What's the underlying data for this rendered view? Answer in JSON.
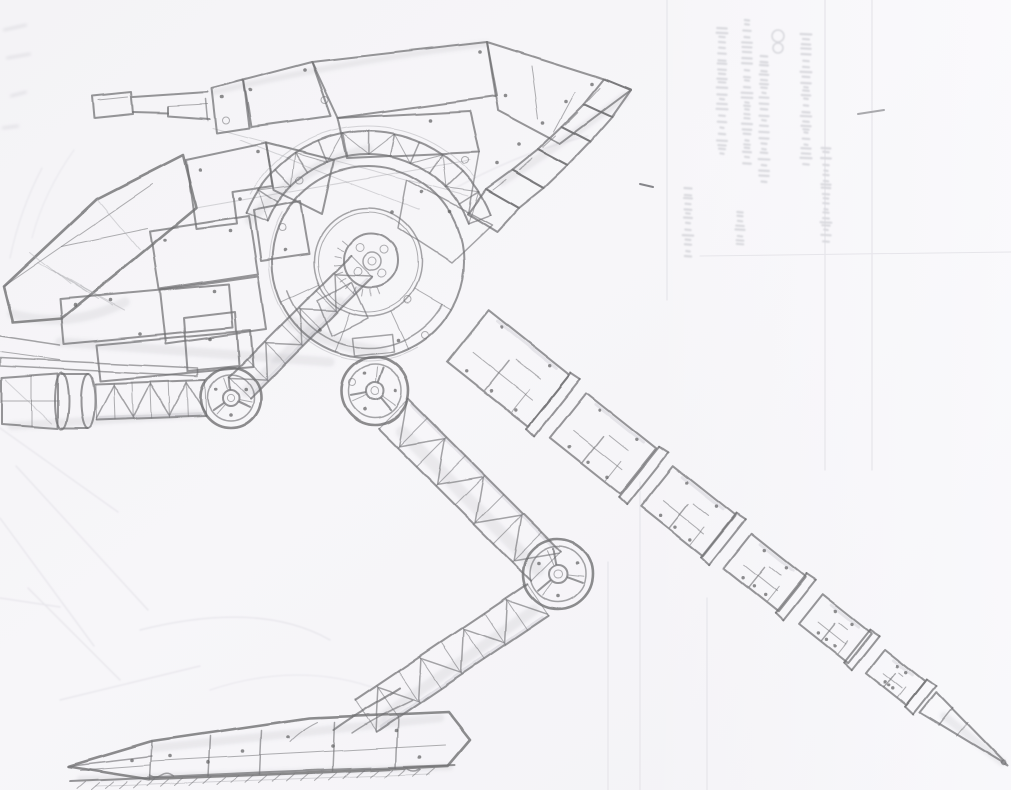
{
  "meta": {
    "title": "Pencil sketch — bipedal walker mech",
    "description": "Graphite pencil sketch on white scanned paper of a two-legged walker robot facing left. It has a long cannon barrel with a boxy muzzle, a faceted pointed nose, a hull of riveted interlocking armor plates, a swept plated wing with stepped flaps over the back, a large circular hip disc with a bolted hub and a curved lattice truss, truss-frame limbs with round spoked joints, a segmented tapering rear leg ending in a spiked tip, and a low wedge-shaped armored foot resting on a hatched ground line. Faint illegible text, fold lines and map-like marks bleed through the paper, mostly in the upper right.",
    "medium": "graphite pencil on paper, scanned"
  },
  "palette": {
    "paper": "#f6f5f8",
    "paper_sheen": "#fbfbfd",
    "paper_shadow": "#ededf1",
    "pencil_dark": "#5e5e60",
    "pencil": "#6f6f72",
    "pencil_light": "#a9a9ad",
    "graphite_shade": "#8a8a93",
    "bleed_through": "#d9d9de",
    "fold_line": "#e6e5ea"
  },
  "parts": [
    {
      "id": "gun-barrel",
      "label": "cannon barrel with boxy muzzle"
    },
    {
      "id": "nose-armor",
      "label": "faceted pointed nose armor"
    },
    {
      "id": "body-armor-plates",
      "label": "riveted hull armor plates"
    },
    {
      "id": "wing-plates",
      "label": "swept wing with stepped flaps"
    },
    {
      "id": "arc-truss",
      "label": "curved lattice truss over hip disc"
    },
    {
      "id": "hip-disc",
      "label": "large circular hip disc with bolted hub"
    },
    {
      "id": "shoulder-truss",
      "label": "lattice strut from hub down to elbow joint"
    },
    {
      "id": "elbow-joint",
      "label": "round spoked elbow joint"
    },
    {
      "id": "forearm-truss",
      "label": "horizontal lattice forearm strut"
    },
    {
      "id": "arm-end-cylinder",
      "label": "cylindrical arm end drum"
    },
    {
      "id": "hip-joint",
      "label": "round spoked hip joint"
    },
    {
      "id": "thigh-truss",
      "label": "lattice thigh strut"
    },
    {
      "id": "knee-joint",
      "label": "round spoked knee joint"
    },
    {
      "id": "shin-truss",
      "label": "lattice shin strut"
    },
    {
      "id": "foot",
      "label": "wedge-shaped segmented foot"
    },
    {
      "id": "right-leg",
      "label": "segmented tapering rear leg with spiked tip"
    },
    {
      "id": "ground",
      "label": "hatched ground line under the foot"
    },
    {
      "id": "scan-artifacts",
      "label": "paper fold lines and illegible bleed-through text"
    }
  ],
  "visible_text": []
}
